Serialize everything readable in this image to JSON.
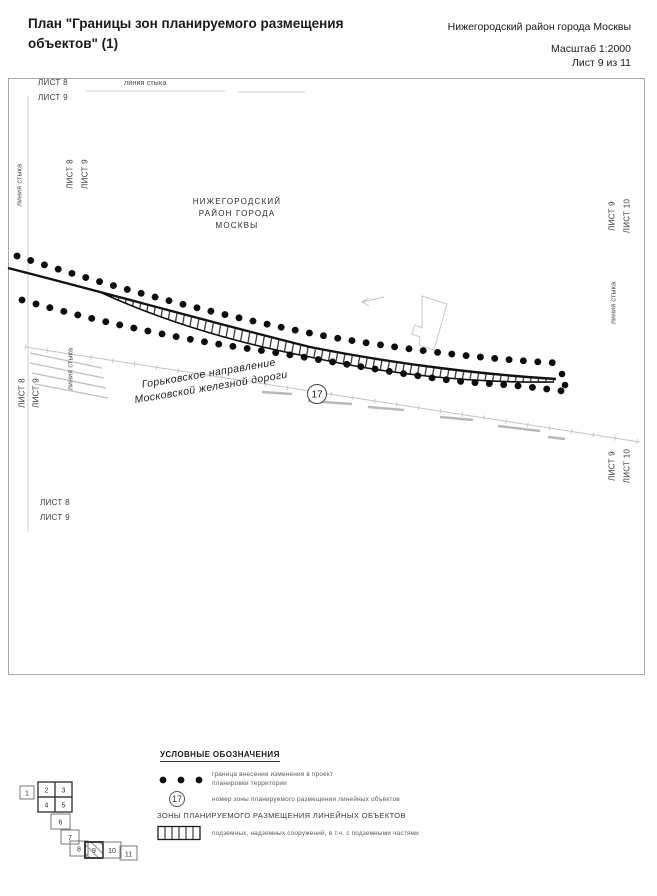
{
  "page": {
    "title_line1": "План \"Границы зон планируемого размещения",
    "title_line2": "объектов\" (1)",
    "info": {
      "district": "Нижегородский район города Москвы",
      "scale": "Масштаб 1:2000",
      "sheet": "Лист 9 из 11"
    }
  },
  "map": {
    "district_label": [
      "НИЖЕГОРОДСКИЙ",
      "РАЙОН ГОРОДА",
      "МОСКВЫ"
    ],
    "railway_label": [
      "Горьковское направление",
      "Московской железной дороги"
    ],
    "zone_number": "17",
    "labels": {
      "sheet8": "ЛИСТ 8",
      "sheet9": "ЛИСТ 9",
      "sheet10": "ЛИСТ 10",
      "joint": "линия стыка"
    }
  },
  "legend": {
    "header": "УСЛОВНЫЕ ОБОЗНАЧЕНИЯ",
    "items": [
      {
        "symbol": "dotted-boundary",
        "label_line1": "граница внесения изменения в проект",
        "label_line2": "планировки территории"
      },
      {
        "symbol": "zone-number-circle",
        "symbol_text": "17",
        "label": "номер зоны планируемого размещения линейных объектов"
      }
    ],
    "subheader": "ЗОНЫ ПЛАНИРУЕМОГО РАЗМЕЩЕНИЯ ЛИНЕЙНЫХ ОБЪЕКТОВ",
    "zone_items": [
      {
        "symbol": "hatched-band",
        "label": "подземных, надземных сооружений, в т.ч. с подземными частями"
      }
    ]
  },
  "sheet_index": {
    "sheets": [
      "1",
      "2",
      "3",
      "4",
      "5",
      "6",
      "7",
      "8",
      "9",
      "10",
      "11"
    ],
    "current": "9"
  }
}
